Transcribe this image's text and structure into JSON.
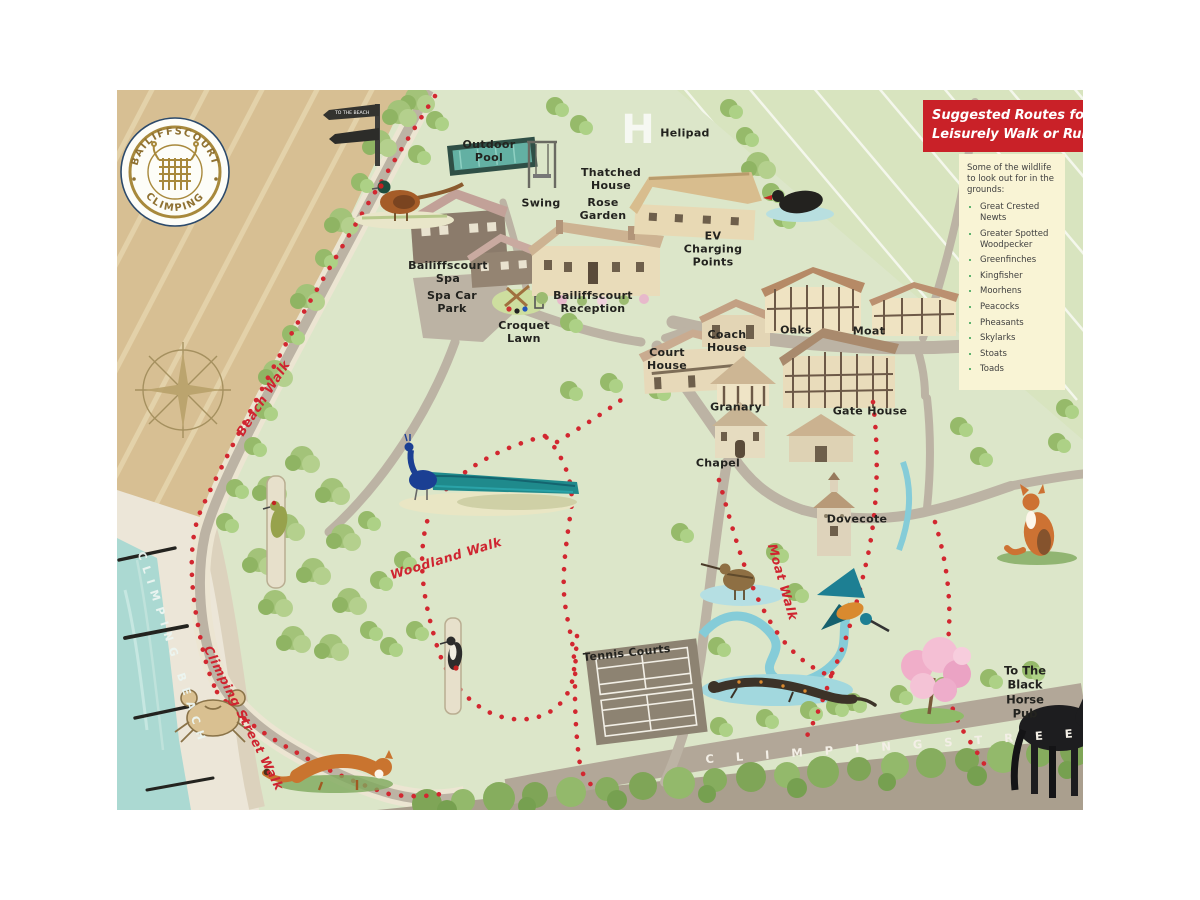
{
  "logo": {
    "arc_top": "BAILIFFSCOURT",
    "arc_bottom": "CLIMPING"
  },
  "banner": {
    "line1": "Suggested Routes for a",
    "line2": "Leisurely Walk or Run"
  },
  "wildlife": {
    "intro": "Some of the wildlife to look out for in the grounds:",
    "items": [
      "Great Crested Newts",
      "Greater Spotted Woodpecker",
      "Greenfinches",
      "Kingfisher",
      "Moorhens",
      "Peacocks",
      "Pheasants",
      "Skylarks",
      "Stoats",
      "Toads"
    ]
  },
  "places": {
    "outdoor_pool": "Outdoor\nPool",
    "swing": "Swing",
    "rose_garden": "Rose\nGarden",
    "helipad_h": "H",
    "helipad": "Helipad",
    "thatched_house": "Thatched\nHouse",
    "ev_charging": "EV\nCharging\nPoints",
    "bailiffscourt_spa": "Bailiffscourt\nSpa",
    "spa_car_park": "Spa Car\nPark",
    "bailiffscourt_reception": "Bailiffscourt\nReception",
    "croquet_lawn": "Croquet\nLawn",
    "court_house": "Court\nHouse",
    "coach_house": "Coach\nHouse",
    "oaks": "Oaks",
    "moat": "Moat",
    "granary": "Granary",
    "gate_house": "Gate House",
    "chapel": "Chapel",
    "dovecote": "Dovecote",
    "tennis_courts": "Tennis Courts"
  },
  "walks": {
    "beach_walk": "Beach Walk",
    "woodland_walk": "Woodland Walk",
    "moat_walk": "Moat Walk",
    "climping_street_walk": "Climping Street Walk"
  },
  "street": {
    "name": "C L I M P I N G   S T R E E T"
  },
  "beach": {
    "name": "CLIMPING BEACH"
  },
  "pub": {
    "label": "To The\nBlack\nHorse Pub"
  },
  "signpost": {
    "text": "TO THE BEACH"
  },
  "colors": {
    "route_red": "#cf2430",
    "banner_red": "#c92128",
    "panel_cream": "#f9f4d5",
    "bullet_green": "#2f9e4e",
    "sea_teal": "#abd9d2",
    "field_tan": "#d7bf93",
    "map_green": "#dce6c9"
  }
}
